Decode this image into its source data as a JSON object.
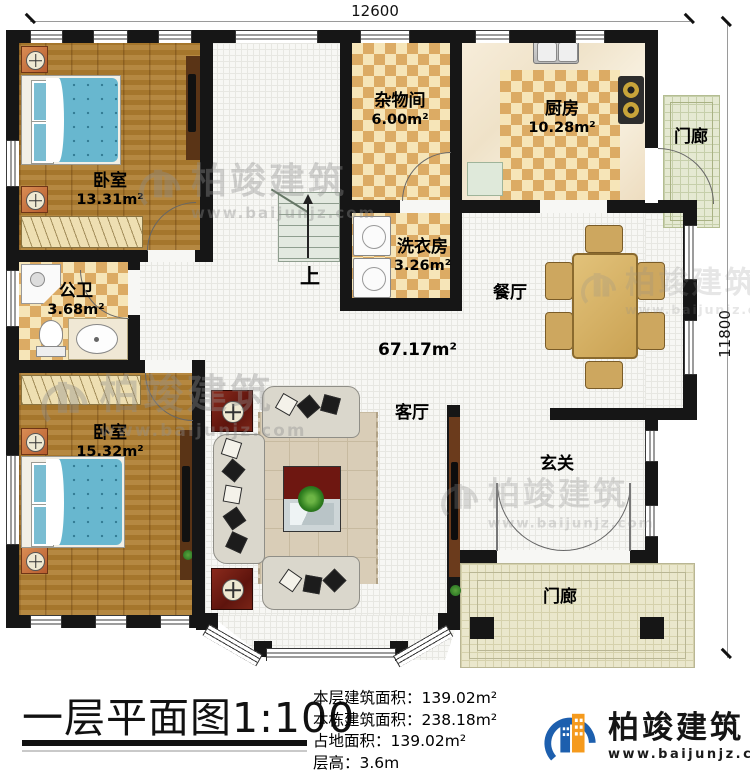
{
  "dim_top": "12600",
  "dim_right": "11800",
  "rooms": {
    "bedroom_top": {
      "label": "卧室",
      "area": "13.31m²"
    },
    "storage": {
      "label": "杂物间",
      "area": "6.00m²"
    },
    "kitchen": {
      "label": "厨房",
      "area": "10.28m²"
    },
    "laundry": {
      "label": "洗衣房",
      "area": "3.26m²"
    },
    "bathroom": {
      "label": "公卫",
      "area": "3.68m²"
    },
    "dining": {
      "label": "餐厅"
    },
    "living": {
      "label": "客厅",
      "area": "67.17m²"
    },
    "bedroom_bottom": {
      "label": "卧室",
      "area": "15.32m²"
    },
    "foyer": {
      "label": "玄关"
    },
    "porch_top": {
      "label": "门廊"
    },
    "porch_bottom": {
      "label": "门廊"
    },
    "stairs_up": {
      "label": "上"
    }
  },
  "title_block": {
    "title": "一层平面图1:100",
    "info": [
      "本层建筑面积：139.02m²",
      "本栋建筑面积：238.18m²",
      "占地面积：139.02m²",
      "层高：3.6m"
    ]
  },
  "branding": {
    "name": "柏竣建筑",
    "url": "www.baijunjz.com"
  }
}
